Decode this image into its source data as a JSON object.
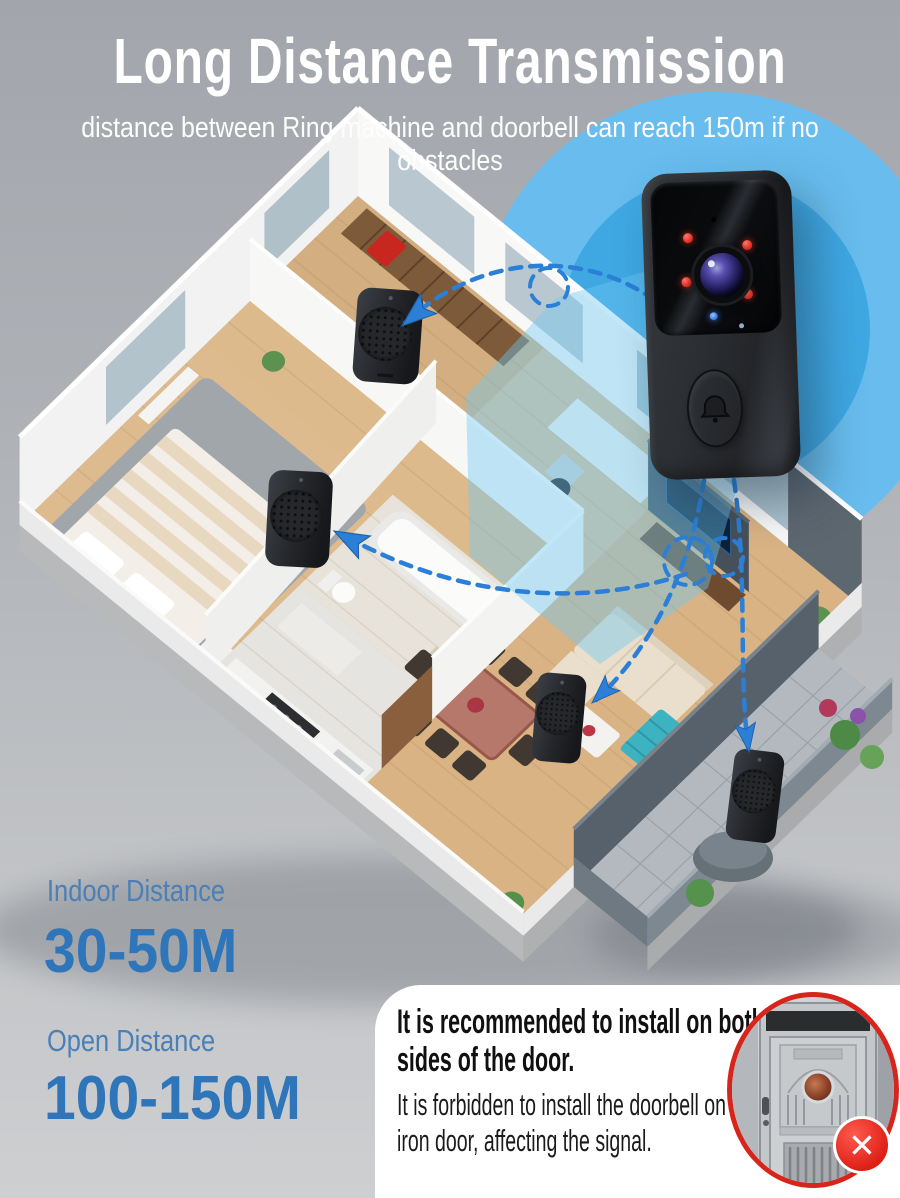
{
  "header": {
    "title": "Long Distance Transmission",
    "subtitle": "distance between Ring machine and doorbell can reach 150m if no obstacles"
  },
  "stats": {
    "indoor_label": "Indoor Distance",
    "indoor_value": "30-50M",
    "open_label": "Open Distance",
    "open_value": "100-150M"
  },
  "note": {
    "title": "It is recommended to install on both sides of the door.",
    "body": "It is forbidden to install the doorbell on the iron door, affecting the signal."
  },
  "icons": {
    "bell_button": "bell-icon",
    "forbidden": "x-icon",
    "forbidden_glyph": "✕"
  },
  "colors": {
    "title_white": "#ffffff",
    "label_blue": "#4a80b6",
    "value_blue": "#2e75ba",
    "signal_outer": "#68bdee",
    "signal_inner": "#3fa8e3",
    "arrow_blue": "#2b7fd6",
    "alert_red": "#d8251c"
  },
  "scene": {
    "device": "wireless video doorbell",
    "receivers": [
      "chime-1",
      "chime-2",
      "chime-3",
      "chime-4"
    ],
    "door_photo": "iron door example"
  }
}
